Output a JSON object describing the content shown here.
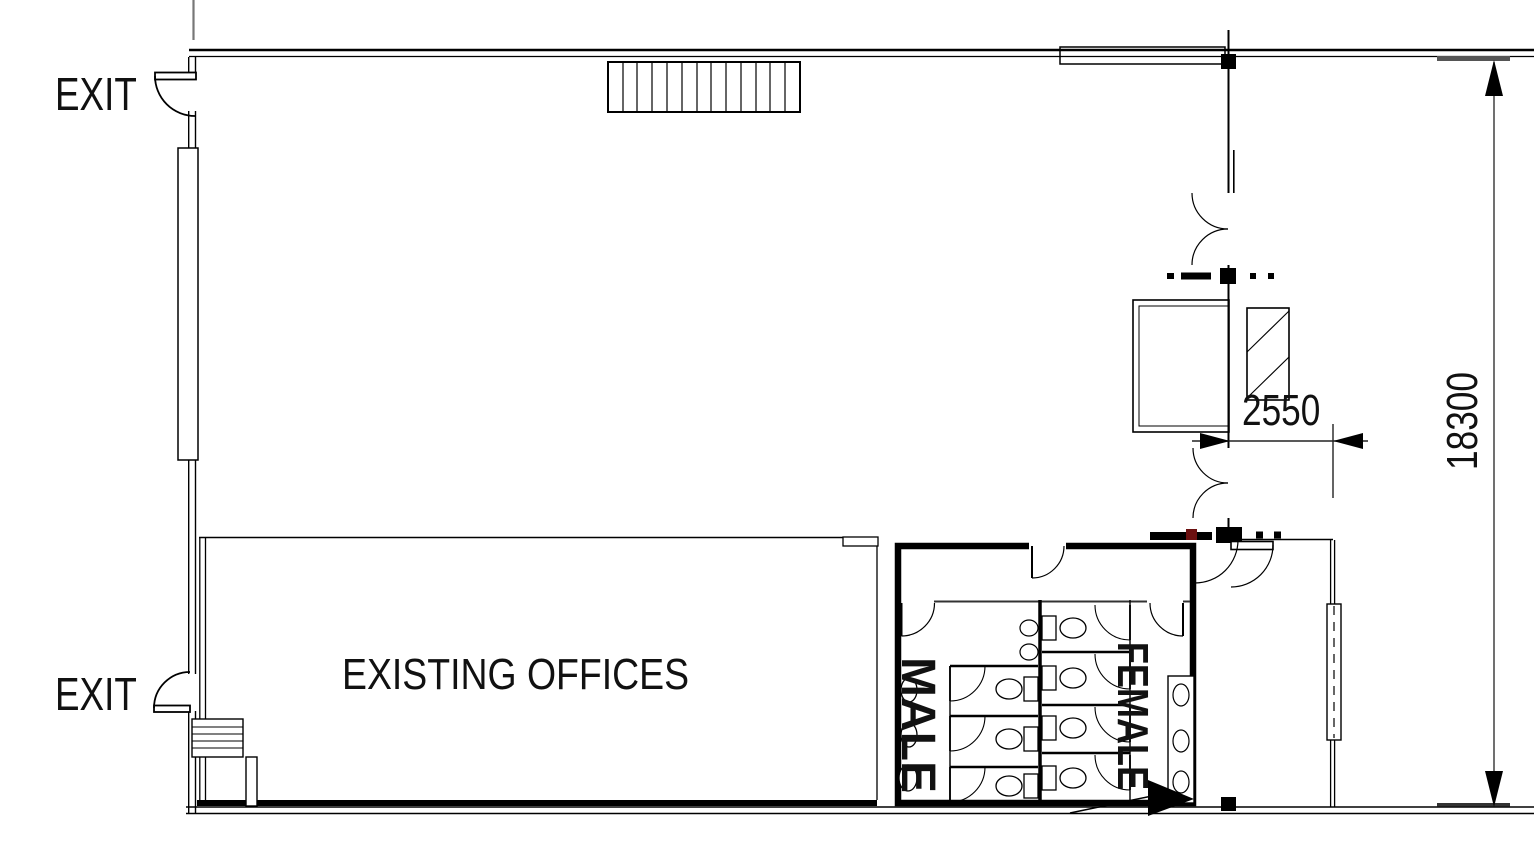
{
  "labels": {
    "exit_top": "EXIT",
    "exit_bottom": "EXIT",
    "existing_offices": "EXISTING OFFICES",
    "male": "MALE",
    "female": "FEMALE"
  },
  "dimensions": {
    "lobby_width": "2550",
    "building_depth": "18300"
  },
  "colors": {
    "line": "#000000",
    "background": "#ffffff",
    "node_accent": "#6b1010",
    "gray_line": "#777777"
  }
}
